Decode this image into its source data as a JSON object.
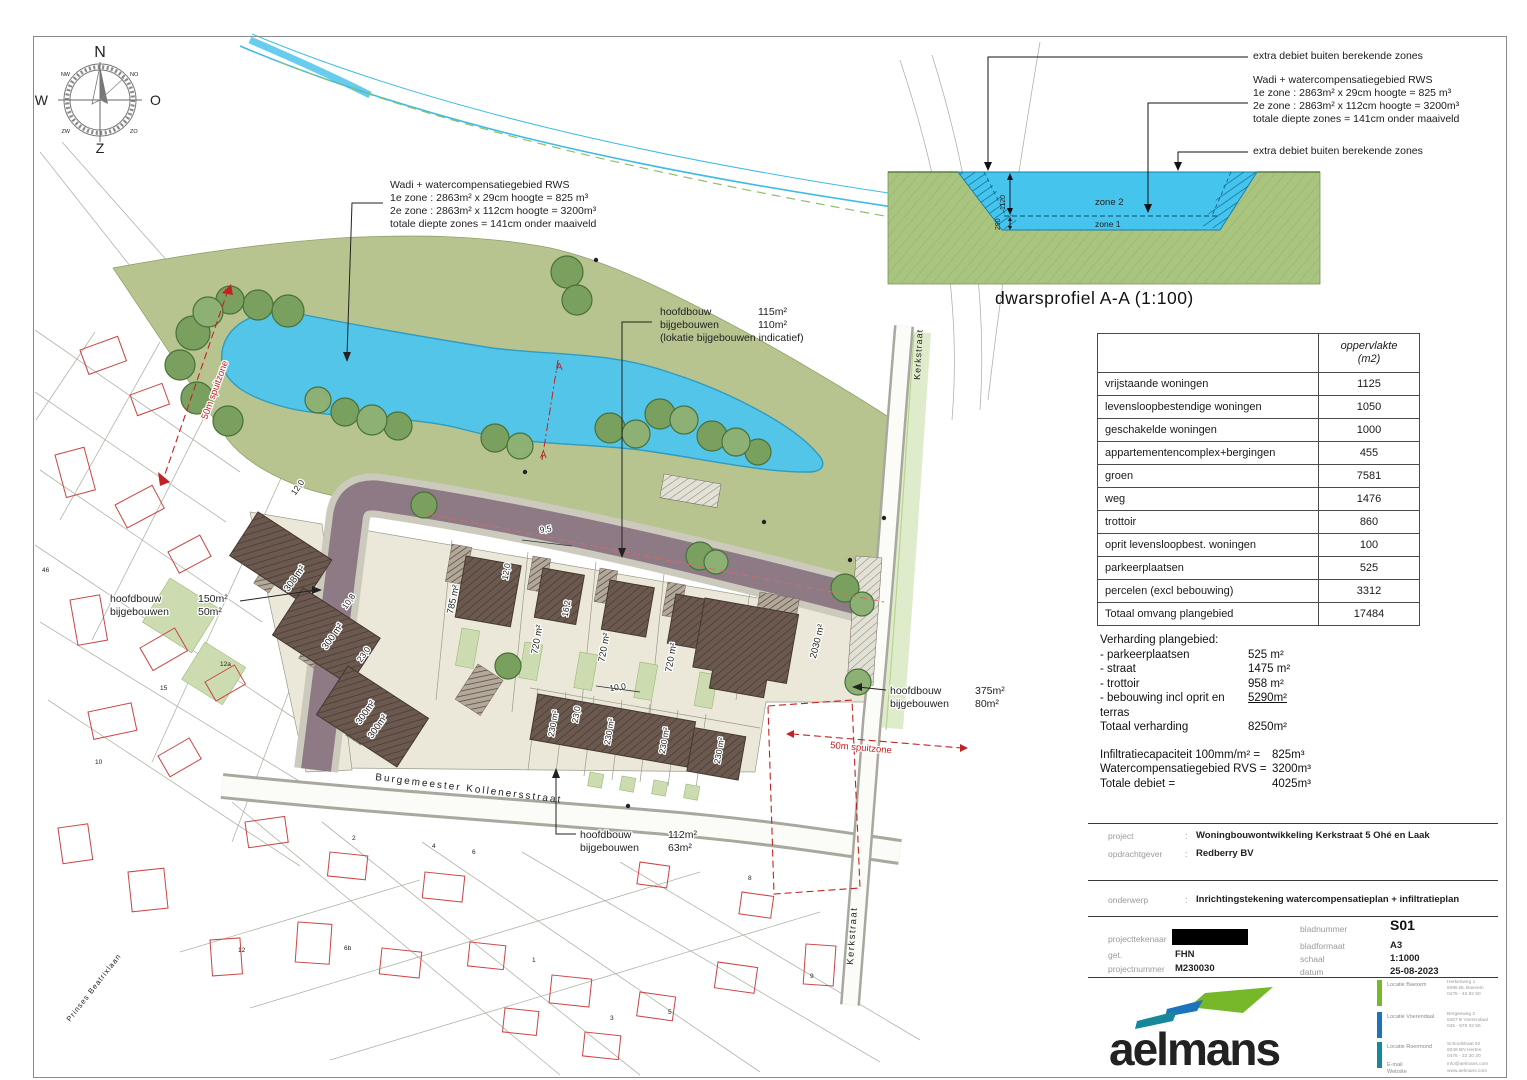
{
  "compass": {
    "n": "N",
    "e": "O",
    "s": "Z",
    "w": "W",
    "ne": "NO",
    "nw": "NW",
    "se": "ZO",
    "sw": "ZW"
  },
  "plan": {
    "wadi_note": [
      "Wadi + watercompensatiegebied RWS",
      "1e zone : 2863m² x 29cm hoogte = 825 m³",
      "2e zone : 2863m² x 112cm hoogte = 3200m³",
      "totale diepte zones = 141cm onder maaiveld"
    ],
    "note_center": {
      "rows": [
        [
          "hoofdbouw",
          "115m²"
        ],
        [
          "bijgebouwen",
          "110m²"
        ]
      ],
      "footnote": "(lokatie bijgebouwen indicatief)"
    },
    "note_left": [
      [
        "hoofdbouw",
        "150m²"
      ],
      [
        "bijgebouwen",
        "50m²"
      ]
    ],
    "note_right": [
      [
        "hoofdbouw",
        "375m²"
      ],
      [
        "bijgebouwen",
        "80m²"
      ]
    ],
    "note_bottom": [
      [
        "hoofdbouw",
        "112m²"
      ],
      [
        "bijgebouwen",
        "63m²"
      ]
    ],
    "spuitzone": "50m spuitzone",
    "street_burgemeester": "Burgemeester Kollenersstraat",
    "street_kerkstraat": "Kerkstraat",
    "street_prinses": "Prinses Beatrixlaan",
    "section_a": "A",
    "lot_labels": [
      "785 m²",
      "720 m²",
      "720 m²",
      "720 m²",
      "2030 m²",
      "308 m²",
      "300 m²",
      "300m²",
      "300m²",
      "230 m²",
      "230 m²",
      "230 m²",
      "230 m²"
    ],
    "dims": [
      "12,0",
      "9,5",
      "12,0",
      "16,2",
      "10,8",
      "23,0",
      "10,0",
      "23,0"
    ],
    "house_numbers": [
      "2",
      "4",
      "6",
      "8",
      "10",
      "12",
      "12a",
      "15",
      "3",
      "5",
      "6b",
      "9",
      "46",
      "1"
    ]
  },
  "profile": {
    "title": "dwarsprofiel A-A (1:100)",
    "note_top": "extra debiet buiten berekende zones",
    "note_mid": [
      "Wadi + watercompensatiegebied RWS",
      "1e zone : 2863m² x 29cm hoogte = 825 m³",
      "2e zone : 2863m² x 112cm hoogte = 3200m³",
      "totale diepte zones = 141cm onder maaiveld"
    ],
    "note_bottom": "extra debiet buiten berekende zones",
    "zone2": "zone 2",
    "zone1": "zone 1",
    "dim_zone2": "1120",
    "dim_zone1": "290"
  },
  "table": {
    "header_line1": "oppervlakte",
    "header_line2": "(m2)",
    "rows": [
      {
        "label": "vrijstaande woningen",
        "value": "1125"
      },
      {
        "label": "levensloopbestendige woningen",
        "value": "1050"
      },
      {
        "label": "geschakelde woningen",
        "value": "1000"
      },
      {
        "label": "appartementencomplex+bergingen",
        "value": "455"
      },
      {
        "label": "groen",
        "value": "7581"
      },
      {
        "label": "weg",
        "value": "1476"
      },
      {
        "label": "trottoir",
        "value": "860"
      },
      {
        "label": "oprit levensloopbest. woningen",
        "value": "100"
      },
      {
        "label": "parkeerplaatsen",
        "value": "525"
      },
      {
        "label": "percelen (excl bebouwing)",
        "value": "3312"
      },
      {
        "label": "Totaal omvang plangebied",
        "value": "17484"
      }
    ]
  },
  "verharding": {
    "title": "Verharding plangebied:",
    "items": [
      {
        "label": "- parkeerplaatsen",
        "value": "525 m²"
      },
      {
        "label": "- straat",
        "value": "1475 m²"
      },
      {
        "label": "- trottoir",
        "value": "958 m²"
      },
      {
        "label": "- bebouwing incl oprit en terras",
        "value": "5290m²"
      }
    ],
    "total": {
      "label": "Totaal verharding",
      "value": "8250m²"
    },
    "infiltration": [
      {
        "label": "Infiltratiecapaciteit 100mm/m² =",
        "value": "825m³"
      },
      {
        "label": "Watercompensatiegebied RVS =",
        "value": "3200m³"
      },
      {
        "label": "Totale debiet =",
        "value": "4025m³"
      }
    ]
  },
  "titleblock": {
    "colon": ":",
    "project_label": "project",
    "project_value": "Woningbouwontwikkeling Kerkstraat 5 Ohé en Laak",
    "client_label": "opdrachtgever",
    "client_value": "Redberry BV",
    "subject_label": "onderwerp",
    "subject_value": "Inrichtingstekening watercompensatieplan + infiltratieplan",
    "drafter_label": "projecttekenaar",
    "get_label": "get.",
    "get_value": "FHN",
    "projectno_label": "projectnummer",
    "projectno_value": "M230030",
    "sheetno_label": "bladnummer",
    "sheetno_value": "S01",
    "format_label": "bladformaat",
    "format_value": "A3",
    "scale_label": "schaal",
    "scale_value": "1:1000",
    "date_label": "datum",
    "date_value": "25-08-2023",
    "logo_text": "aelmans",
    "locations": [
      {
        "label": "Locatie Baexem",
        "l1": "Herkenweg 1",
        "l2": "6095 BL Baexem",
        "l3": "0475 - 45 92 60"
      },
      {
        "label": "Locatie Voerendaal",
        "l1": "Bergseweg 2",
        "l2": "6367 B Voerendaal",
        "l3": "045 - 575 32 55"
      },
      {
        "label": "Locatie Roermond",
        "l1": "Schoolstraat 52",
        "l2": "6049 BN Herten",
        "l3": "0475 - 33 30 30"
      }
    ],
    "email_label": "E-mail",
    "email_value": "info@aelmans.com",
    "web_label": "Website",
    "web_value": "www.aelmans.com"
  },
  "colors": {
    "accent_red": "#c42222",
    "water": "#52c5e9",
    "site_green": "#b7c48f",
    "road": "#8d7a85",
    "tree": "#7aa05f",
    "logo_teal": "#2a7a74",
    "logo_green": "#76b82a",
    "logo_blue": "#1b75bb"
  }
}
